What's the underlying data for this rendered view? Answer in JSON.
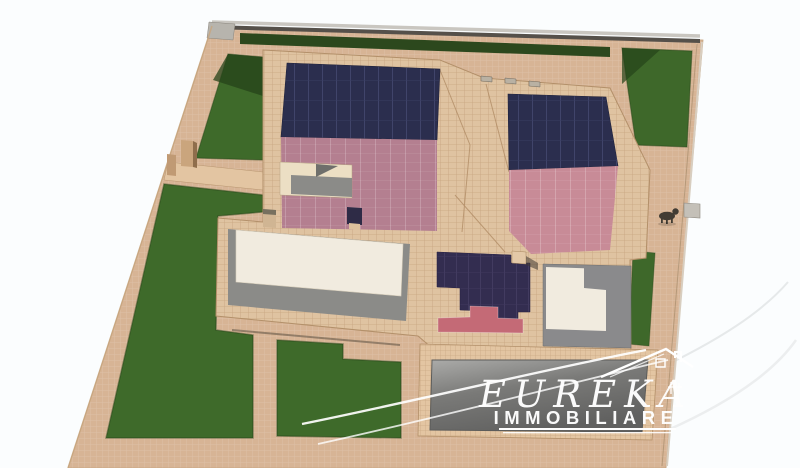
{
  "watermark": {
    "brand": "EUREKA",
    "subtitle": "IMMOBILIARE",
    "icon": "house-outline-icon",
    "color": "#ffffff"
  },
  "colors": {
    "background": "#fbfdfe",
    "paving": "#d7b495",
    "pavingLight": "#e3c5a2",
    "roofTile": "#dfc3a1",
    "solarPanel": "#2b2e4e",
    "solarPanelDark": "#332d50",
    "roofPinkA": "#b47f90",
    "roofPinkB": "#c88b97",
    "roofPinkAccent": "#c46a76",
    "hedge": "#2c481d",
    "lawn": "#3e6a2a",
    "lawnBright": "#3e682a",
    "lawnShade": "#25431a",
    "whiteRoof": "#f1ebdf",
    "creamEdge": "#ecdfc4",
    "grayFloor": "#8b8b88",
    "grayPatio": "#8a8a8c",
    "parkingDark": "#6f6f6d",
    "fenceDark": "#55504a",
    "fenceLight": "#c9c6c0",
    "pillar": "#caa57d",
    "chimneyNavy": "#2e2b46",
    "animal": "#423c34"
  }
}
